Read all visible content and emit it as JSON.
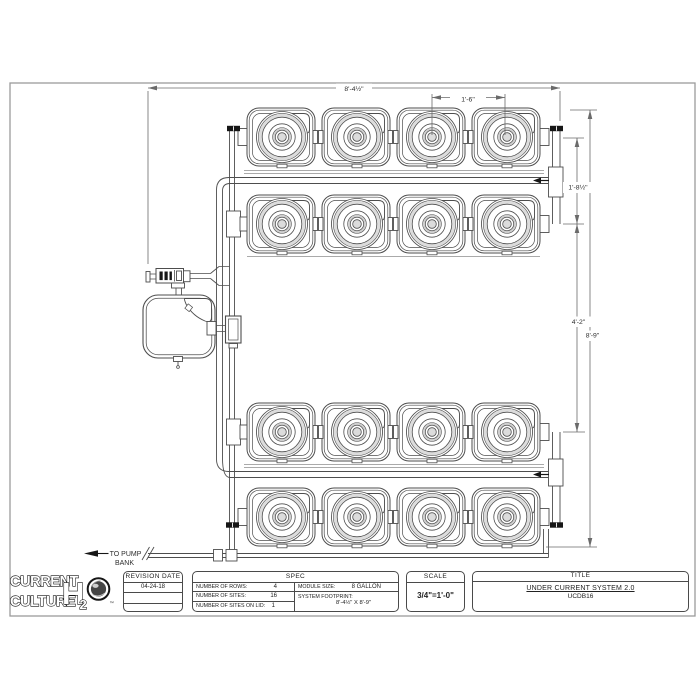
{
  "logo": {
    "word1": "CURRENT",
    "word2": "CULTURE",
    "h": "H",
    "two": "2",
    "tm": "™"
  },
  "drawing": {
    "grid": {
      "rows": 4,
      "cols": 4
    },
    "dims": {
      "overall_width": "8'-4½\"",
      "col_spacing": "1'-6\"",
      "row_spacing": "1'-8½\"",
      "group_spacing": "4'-2\"",
      "overall_height": "8'-9\"",
      "pump_note_line1": "TO PUMP",
      "pump_note_line2": "BANK"
    }
  },
  "titleblock": {
    "revision": {
      "header": "REVISION DATE",
      "date": "04-24-18"
    },
    "spec": {
      "header": "SPEC",
      "rows_label": "NUMBER OF ROWS:",
      "rows_value": "4",
      "sites_label": "NUMBER OF SITES:",
      "sites_value": "16",
      "lid_label": "NUMBER OF SITES ON LID:",
      "lid_value": "1",
      "module_label": "MODULE SIZE:",
      "module_value": "8 GALLON",
      "footprint_label": "SYSTEM FOOTPRINT:",
      "footprint_value": "8'-4½\" X 8'-9\""
    },
    "scale": {
      "header": "SCALE",
      "value": "3/4\"=1'-0\""
    },
    "title": {
      "header": "TITLE",
      "line1": "UNDER CURRENT SYSTEM 2.0",
      "line2": "UCDB16"
    }
  },
  "colors": {
    "linework": "#4d4d4d",
    "dimension": "#6a6a6a",
    "border": "#9b9b9b",
    "cap_black": "#161616",
    "ring_gray": "#dcdcdc"
  }
}
